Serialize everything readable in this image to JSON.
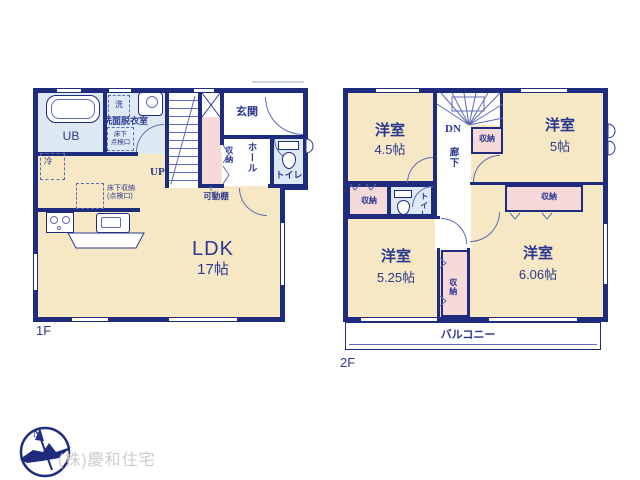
{
  "colors": {
    "wall": "#1f2b7d",
    "text": "#2b3890",
    "room_cream": "#f6e8c4",
    "room_blue": "#dde9f5",
    "room_pink": "#f6dada",
    "company_gray": "#cdcdcd"
  },
  "floor1": {
    "label": "1F",
    "unit_bath": "UB",
    "washer": "洗",
    "washroom": "洗面脱衣室",
    "hatch": [
      "床下",
      "点検口"
    ],
    "fridge": "冷",
    "underfloor_storage": [
      "床下収納",
      "(点検口)"
    ],
    "stairs_up": "UP",
    "entrance": "玄関",
    "hall": "ホール",
    "storage": "収納",
    "movable_shelf": "可動棚",
    "toilet": "トイレ",
    "counter": "カウンター",
    "ldk": "LDK",
    "ldk_size": "17帖"
  },
  "floor2": {
    "label": "2F",
    "stairs_dn": "DN",
    "corridor": "廊下",
    "toilet": "トイレ",
    "storage": "収納",
    "balcony": "バルコニー",
    "rooms": [
      {
        "name": "洋室",
        "size": "4.5帖"
      },
      {
        "name": "洋室",
        "size": "5帖"
      },
      {
        "name": "洋室",
        "size": "5.25帖"
      },
      {
        "name": "洋室",
        "size": "6.06帖"
      }
    ]
  },
  "footer": {
    "company": "(株)慶和住宅"
  },
  "compass": {
    "north": "N"
  }
}
